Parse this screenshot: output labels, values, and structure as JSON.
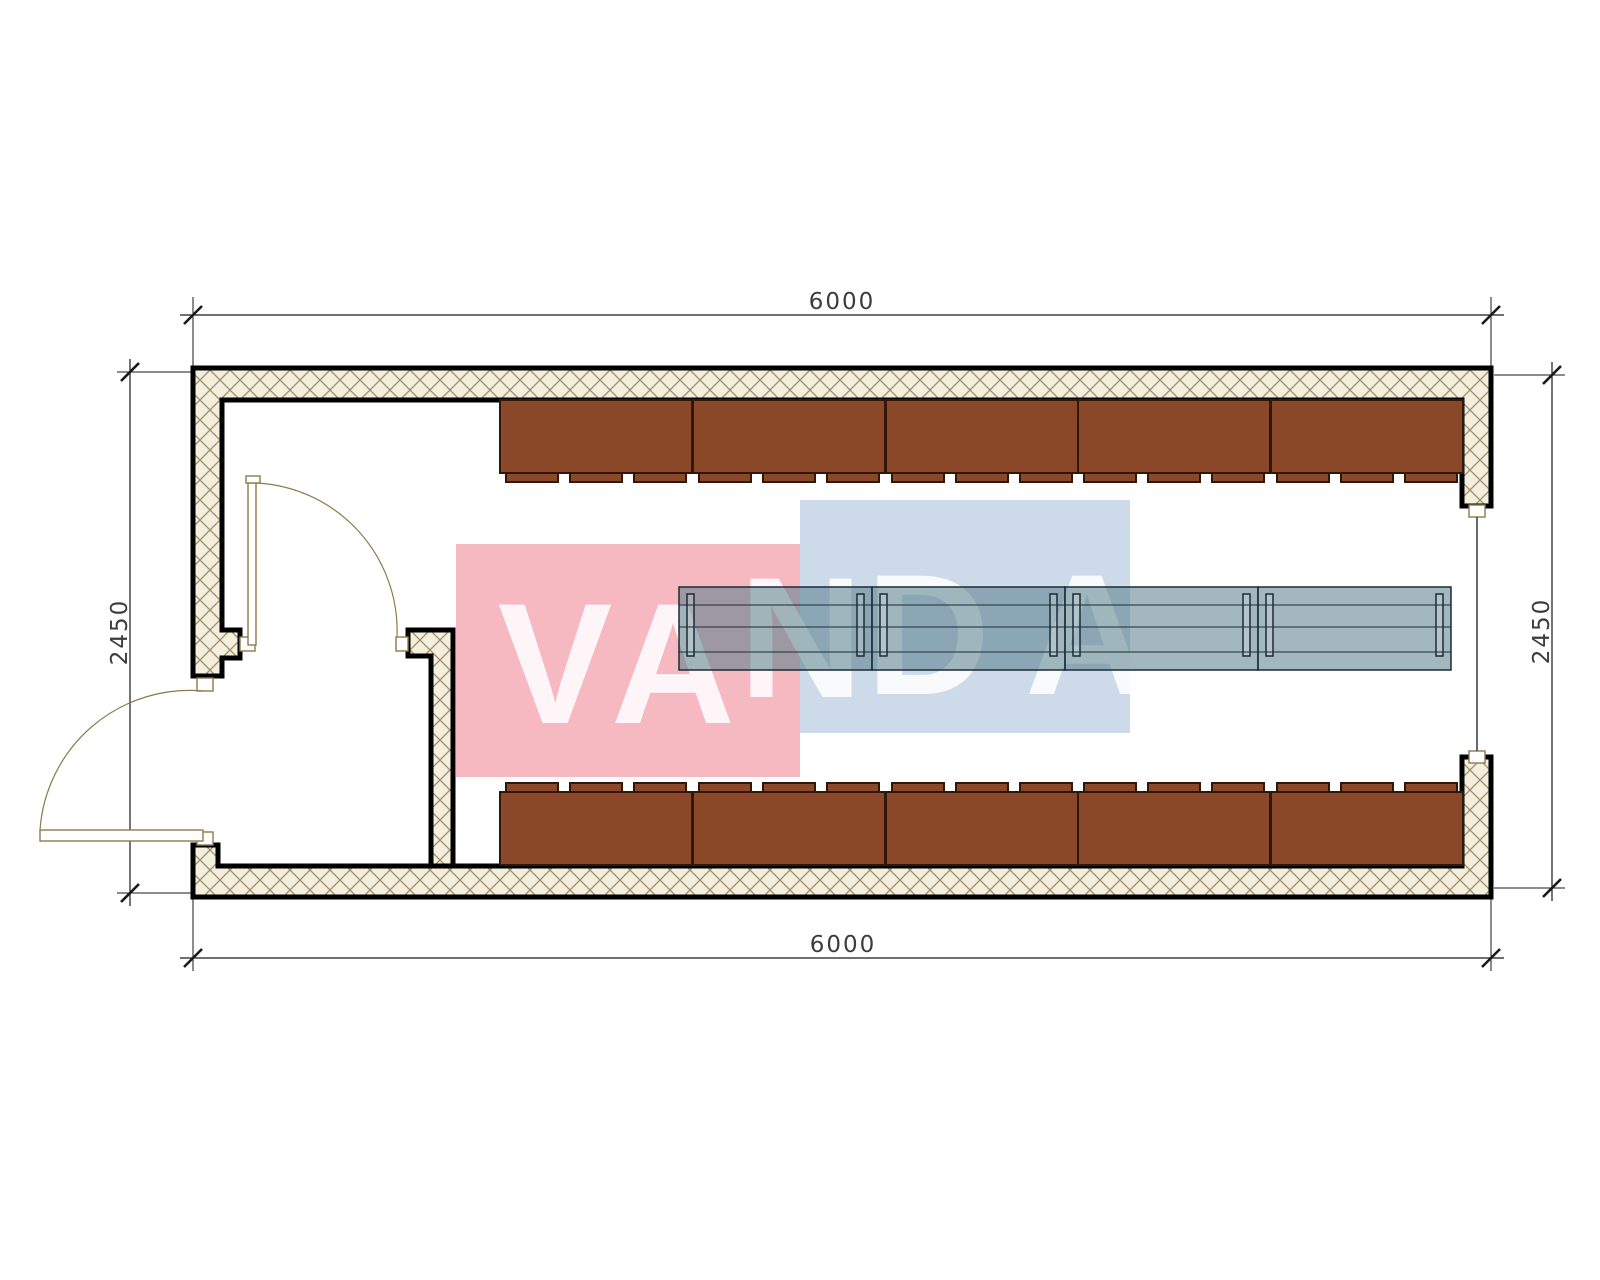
{
  "drawing": {
    "kind": "floor-plan",
    "description": "Rectangular modular container floor plan with entry vestibule, two locker rows and central table row"
  },
  "dimensions": {
    "top": "6000",
    "bottom": "6000",
    "left": "2450",
    "right": "2450"
  },
  "watermark": {
    "text": "VANDA",
    "letters": [
      {
        "char": "V"
      },
      {
        "char": "A"
      },
      {
        "char": "N"
      },
      {
        "char": "D"
      },
      {
        "char": "A"
      }
    ],
    "pink": "#f6b8c1",
    "blue": "#ccdaea",
    "letter_color": "#ffffff"
  },
  "colors": {
    "background": "#ffffff",
    "wall_outline": "#000000",
    "wall_hatch_fill": "#f4eedd",
    "wall_hatch_line": "#9c8d6b",
    "locker_fill": "#8a4829",
    "locker_outline": "#30170a",
    "table_fill": "#557d89",
    "table_outline": "#1c2b36",
    "door_line": "#8d7b4a",
    "window_line": "#2c3850",
    "dimension_line": "#1a1a1a",
    "dimension_text": "#3c3c3c"
  },
  "furniture": {
    "top_locker_count": 5,
    "bottom_locker_count": 5,
    "table_section_count": 4,
    "door_count": 2,
    "window_count": 1
  }
}
